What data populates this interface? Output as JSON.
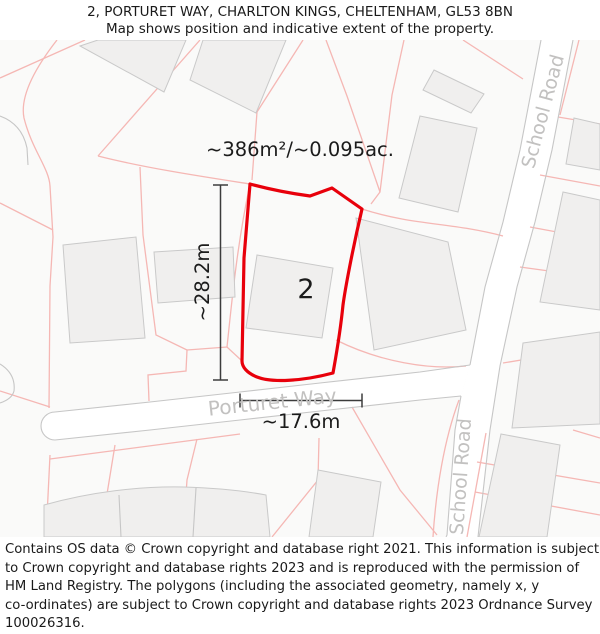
{
  "header": {
    "line1": "2, PORTURET WAY, CHARLTON KINGS, CHELTENHAM, GL53 8BN",
    "line2": "Map shows position and indicative extent of the property."
  },
  "map": {
    "area_label": "~386m²/~0.095ac.",
    "plot_number": "2",
    "dim_vertical": "~28.2m",
    "dim_horizontal": "~17.6m",
    "road_porturet": "Porturet Way",
    "road_school_top": "School Road",
    "road_school_bottom": "School Road"
  },
  "footer": {
    "lines": [
      "Contains OS data © Crown copyright and database right 2021. This information is subject",
      "to Crown copyright and database rights 2023 and is reproduced with the permission of",
      "HM Land Registry. The polygons (including the associated geometry, namely x, y",
      "co-ordinates) are subject to Crown copyright and database rights 2023 Ordnance Survey",
      "100026316."
    ]
  },
  "colors": {
    "property_outline": "#e8000b",
    "parcel_line": "#f5b7b4",
    "road_edge": "#c6c6c6",
    "building_fill": "#f0efee",
    "map_background": "#fafaf9",
    "road_label": "#c2c1c0",
    "text": "#1a1a1a"
  }
}
